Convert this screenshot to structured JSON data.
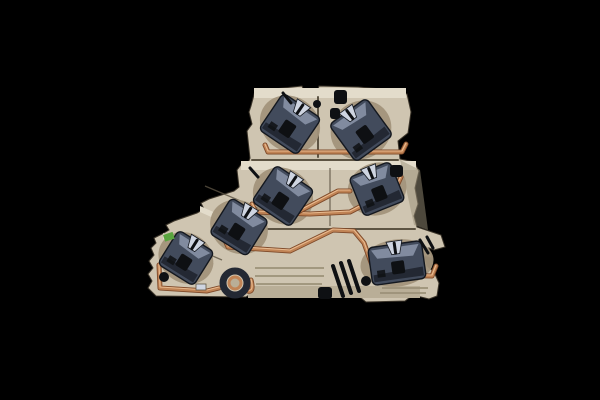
{
  "scene": {
    "alt": "Cutaway photograph of a beige multi-level DIN-rail feed-through terminal block with seven dark steel tension clamps, copper busbars, a circular foot clamp and a small green marking, on a black background",
    "background": "#000000"
  },
  "palette": {
    "background": "#000000",
    "housing": "#cfc5b1",
    "housing_light": "#e3dccb",
    "housing_mid": "#b9ae97",
    "housing_shadow": "#9a8f77",
    "housing_deep": "#5d5443",
    "outline": "#3c352a",
    "cavity": "#a2947b",
    "clamp_dark": "#232833",
    "clamp_mid": "#424b5c",
    "clamp_light": "#8c96aa",
    "clamp_bright": "#cfd5e1",
    "clamp_edge": "#14181f",
    "hole_dark": "#0e1013",
    "copper": "#c08355",
    "copper_light": "#ecc096",
    "copper_dark": "#7e4a2a",
    "green_mark": "#59a43e"
  },
  "clamps": [
    {
      "name": "tension-clamp-top-left",
      "cx": 290,
      "cy": 124,
      "w": 46,
      "h": 44,
      "rot": 34
    },
    {
      "name": "tension-clamp-top-right",
      "cx": 361,
      "cy": 130,
      "w": 46,
      "h": 46,
      "rot": -36
    },
    {
      "name": "tension-clamp-mid-left",
      "cx": 283,
      "cy": 196,
      "w": 46,
      "h": 44,
      "rot": 34
    },
    {
      "name": "tension-clamp-mid-right",
      "cx": 377,
      "cy": 189,
      "w": 44,
      "h": 42,
      "rot": -22
    },
    {
      "name": "tension-clamp-step-left",
      "cx": 239,
      "cy": 227,
      "w": 44,
      "h": 42,
      "rot": 32
    },
    {
      "name": "tension-clamp-lower-left",
      "cx": 186,
      "cy": 258,
      "w": 42,
      "h": 40,
      "rot": 32
    },
    {
      "name": "tension-clamp-bottom-right",
      "cx": 397,
      "cy": 263,
      "w": 54,
      "h": 38,
      "rot": -8
    }
  ],
  "copper_paths": [
    {
      "name": "busbar-level1",
      "d": "M265,145 L268,152 L402,152 L406,144"
    },
    {
      "name": "busbar-level2",
      "d": "M252,204 L256,212 L310,214 L350,212 L396,188 L401,177"
    },
    {
      "name": "busbar-level2-branch",
      "d": "M298,212 L338,191 L350,191"
    },
    {
      "name": "busbar-level3",
      "d": "M224,238 L228,247 L290,251 L333,230 L354,231 L364,243 L373,268 L381,275 L432,276 L436,266"
    },
    {
      "name": "busbar-level4",
      "d": "M159,265 L160,288 L207,291 L219,288"
    },
    {
      "name": "busbar-ring-tail",
      "d": "M245,290 Q255,295 251,280"
    }
  ],
  "holes": [
    {
      "name": "vent-hole-top-right-a",
      "type": "rrect",
      "x": 334,
      "y": 90,
      "w": 13,
      "h": 14
    },
    {
      "name": "vent-hole-top-right-b",
      "type": "rrect",
      "x": 330,
      "y": 108,
      "w": 10,
      "h": 11
    },
    {
      "name": "vent-hole-mid-right",
      "type": "rrect",
      "x": 390,
      "y": 165,
      "w": 13,
      "h": 12
    },
    {
      "name": "center-notch-hole",
      "type": "circle",
      "cx": 317,
      "cy": 104,
      "r": 4
    },
    {
      "name": "base-hole-right",
      "type": "circle",
      "cx": 366,
      "cy": 281,
      "r": 5
    },
    {
      "name": "base-hole-left",
      "type": "circle",
      "cx": 164,
      "cy": 277,
      "r": 5
    },
    {
      "name": "rail-slot",
      "type": "rrect",
      "x": 318,
      "y": 287,
      "w": 14,
      "h": 12
    }
  ],
  "slots": [
    {
      "name": "rail-guide-slot-1",
      "x1": 333,
      "y1": 266,
      "x2": 343,
      "y2": 296
    },
    {
      "name": "rail-guide-slot-2",
      "x1": 341,
      "y1": 263,
      "x2": 351,
      "y2": 293
    },
    {
      "name": "rail-guide-slot-3",
      "x1": 349,
      "y1": 261,
      "x2": 359,
      "y2": 291
    }
  ],
  "slits": [
    {
      "name": "wire-entry-slit-level1",
      "x1": 283,
      "y1": 93,
      "x2": 291,
      "y2": 103
    },
    {
      "name": "wire-entry-slit-level2",
      "x1": 250,
      "y1": 168,
      "x2": 258,
      "y2": 177
    },
    {
      "name": "claw-notch-right-a",
      "x1": 420,
      "y1": 240,
      "x2": 428,
      "y2": 253
    },
    {
      "name": "claw-notch-right-b",
      "x1": 427,
      "y1": 237,
      "x2": 433,
      "y2": 248
    }
  ],
  "ring_clamp": {
    "name": "foot-ring-clamp",
    "cx": 235,
    "cy": 283,
    "r_outer": 12,
    "r_inner": 6
  },
  "green_mark": {
    "x": 163,
    "y": 235,
    "w": 10,
    "h": 7,
    "rot": -18
  },
  "metal_bit": {
    "x": 196,
    "y": 284,
    "w": 10,
    "h": 6
  }
}
